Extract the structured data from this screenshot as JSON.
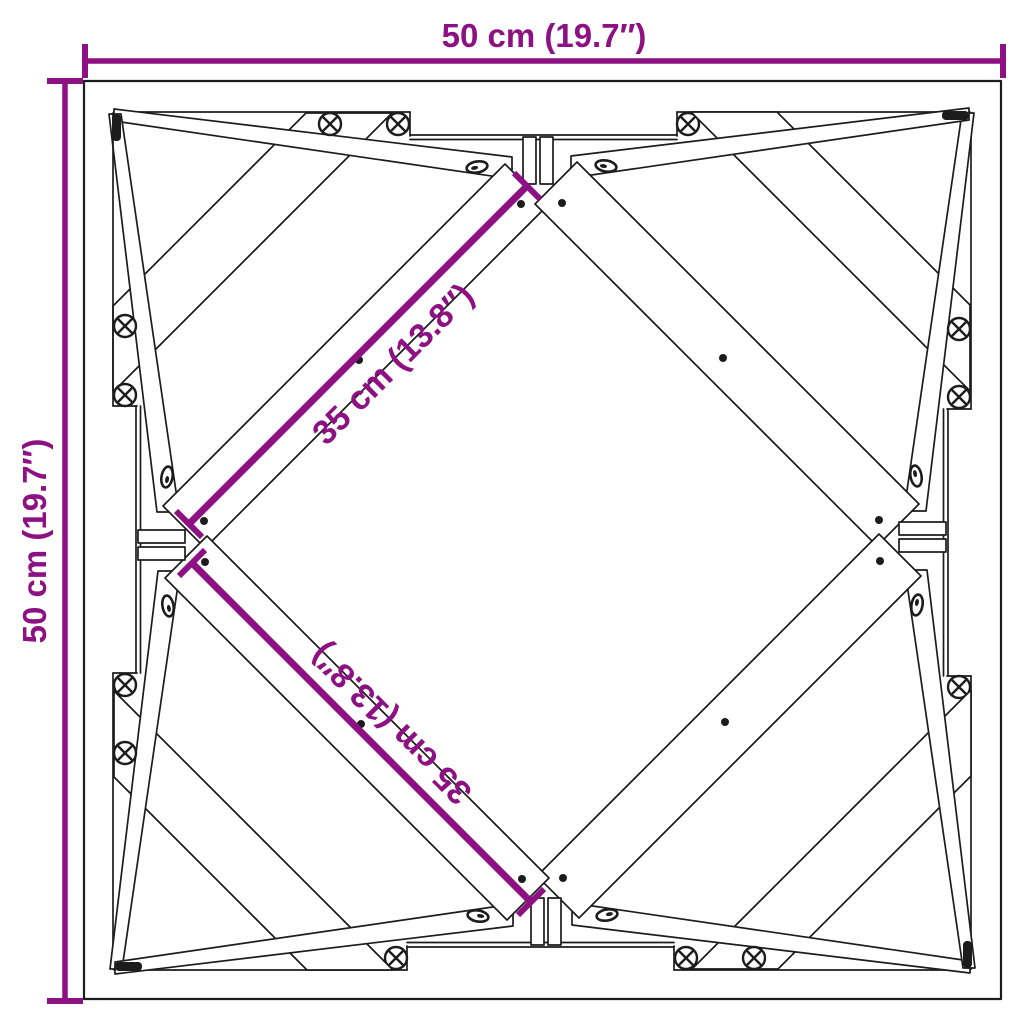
{
  "diagram": {
    "labels": {
      "width_top": "50 cm (19.7″)",
      "height_left": "50 cm (19.7″)",
      "diagonal_upper": "35 cm (13.8″)",
      "diagonal_lower": "35 cm (13.8″)"
    },
    "colors": {
      "dimension_accent": "#8D1182",
      "line_black": "#1c1c1c",
      "background": "#ffffff"
    }
  }
}
